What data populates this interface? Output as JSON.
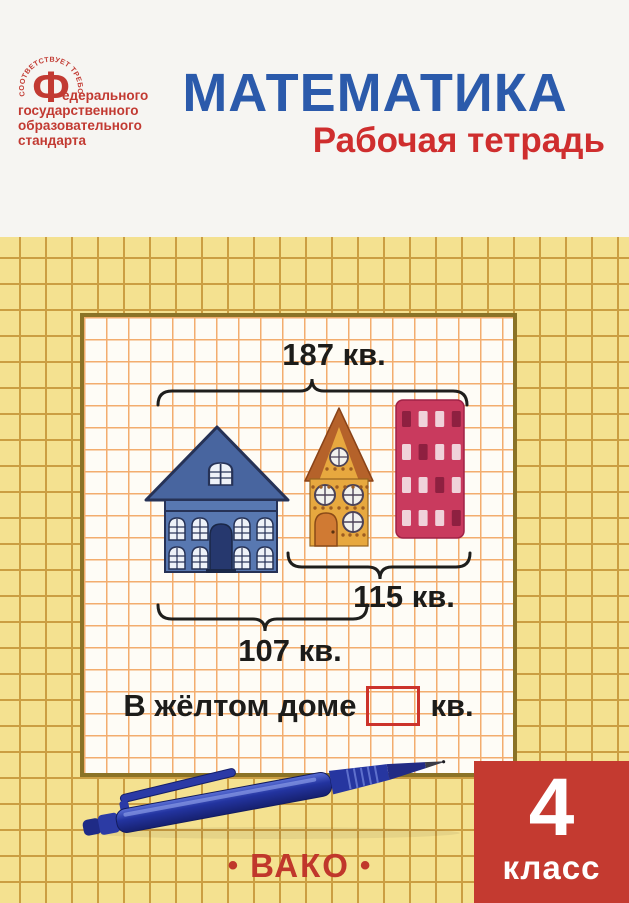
{
  "header": {
    "title": "МАТЕМАТИКА",
    "subtitle": "Рабочая тетрадь"
  },
  "fgos_logo": {
    "arc_text": "СООТВЕТСТВУЕТ ТРЕБОВАНИЯМ",
    "big_letter": "Ф",
    "line1": "едерального",
    "line2": "государственного",
    "line3": "образовательного",
    "line4": "стандарта"
  },
  "worksheet": {
    "total_label": "187 кв.",
    "right_label": "115 кв.",
    "left_label": "107 кв.",
    "question_prefix": "В жёлтом доме",
    "question_suffix": "кв.",
    "answer_value": ""
  },
  "illustration": {
    "building_window_pattern": [
      "dlld",
      "ldll",
      "lldl",
      "llld"
    ],
    "building_window_colors": {
      "d": "#8e2040",
      "l": "#f0d2da"
    }
  },
  "footer": {
    "dot": "•",
    "publisher": "ВАКО",
    "grade_number": "4",
    "grade_word": "класс"
  },
  "colors": {
    "title_blue": "#2b5aab",
    "subtitle_red": "#cf2e2e",
    "badge_red": "#c43a30",
    "cover_yellow": "#f4e190",
    "yellow_grid_line": "#cb9e42",
    "panel_grid_line": "#f3ad6e",
    "panel_border": "#8b7326",
    "answer_box_red": "#cc332b",
    "logo_red": "#c23a32",
    "blue_house": "#5878b1",
    "yellow_house": "#e7a83f",
    "red_building": "#c93a5e",
    "pen_blue": "#2c3ba4"
  }
}
